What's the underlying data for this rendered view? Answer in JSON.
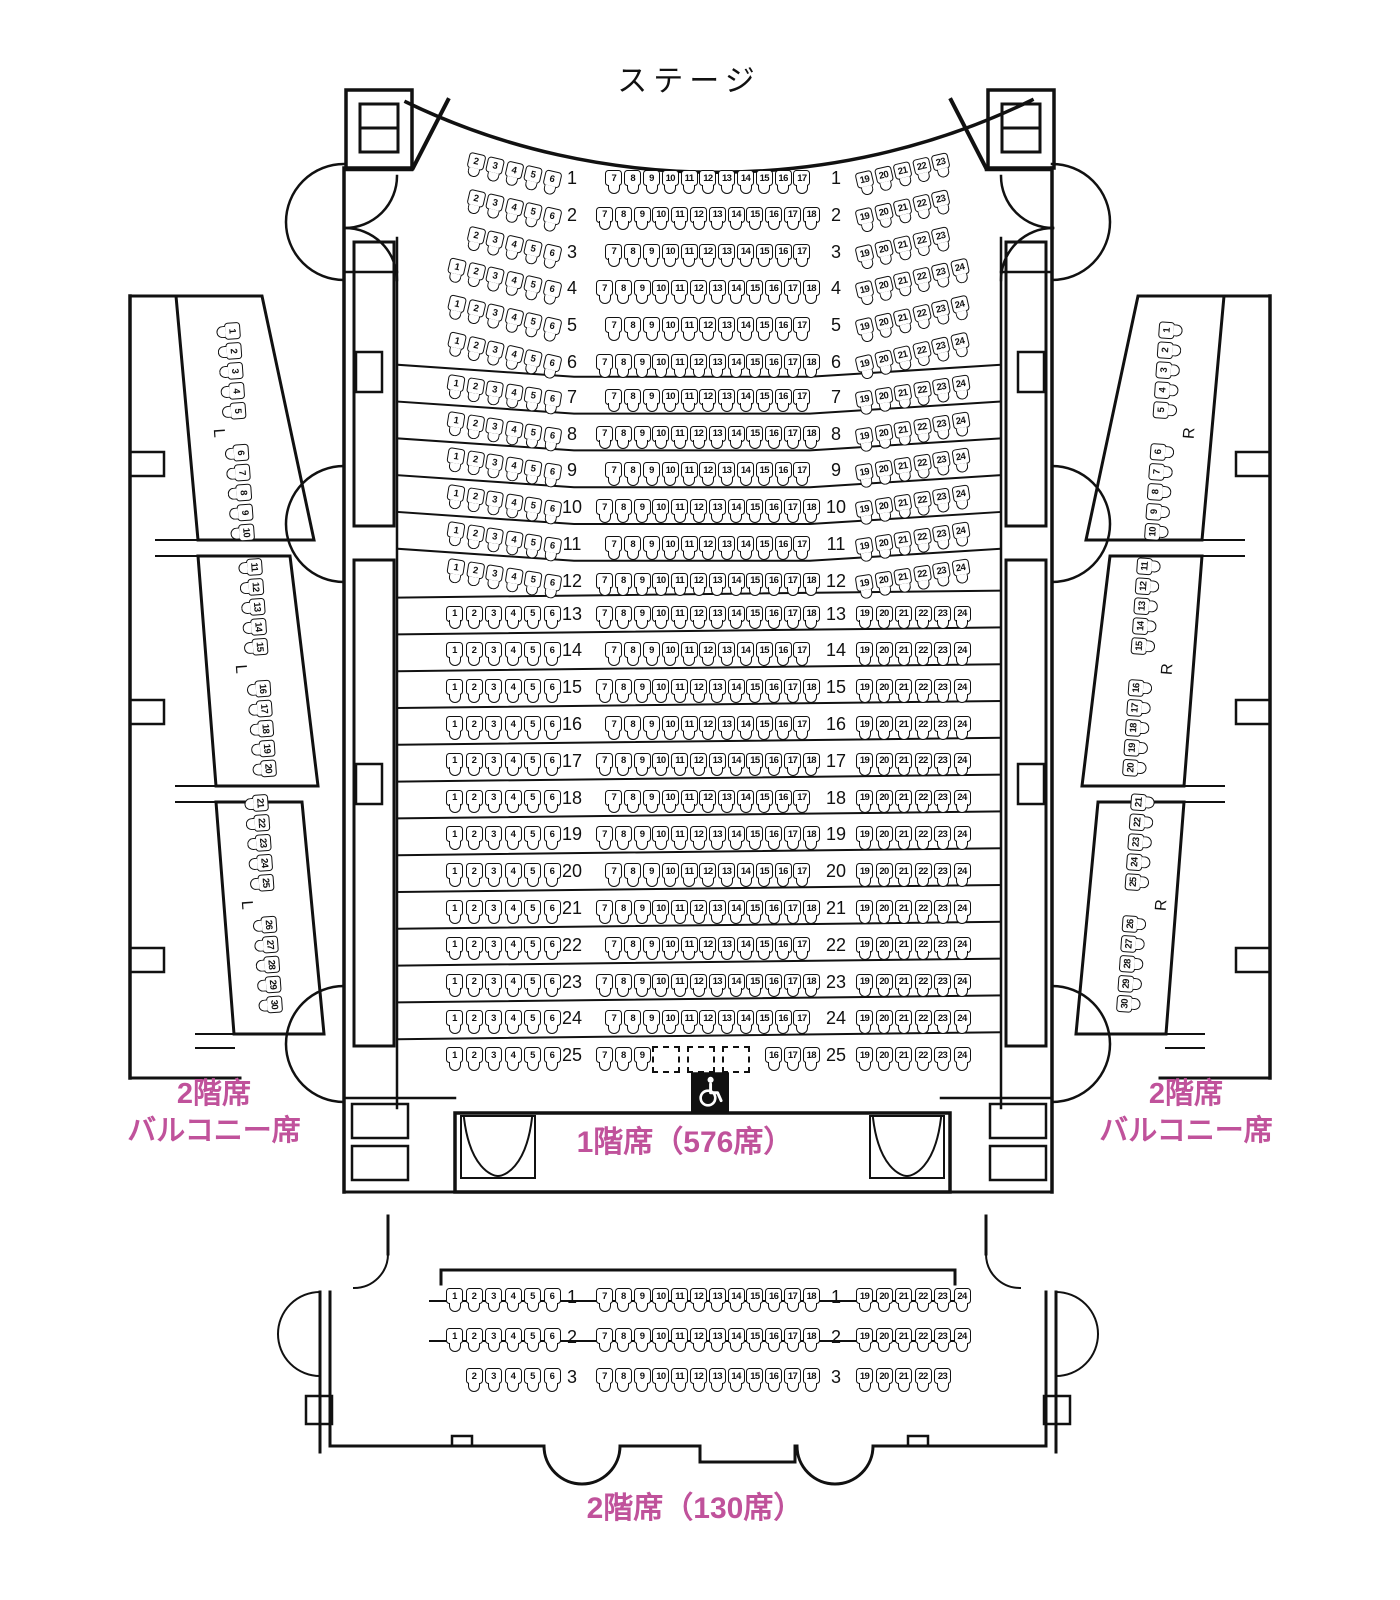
{
  "labels": {
    "stage": "ステージ",
    "floor1": "1階席（576席）",
    "floor2": "2階席（130席）",
    "balcony_line1": "2階席",
    "balcony_line2": "バルコニー席"
  },
  "colors": {
    "accent_pink": "#c0529b",
    "line": "#111111"
  },
  "icons": {
    "wheelchair_icon": "♿"
  },
  "floor1": {
    "label": "1階席（576席）",
    "rows": [
      {
        "n": 1,
        "left": [
          2,
          3,
          4,
          5,
          6
        ],
        "center": [
          7,
          8,
          9,
          10,
          11,
          12,
          13,
          14,
          15,
          16,
          17
        ],
        "right": [
          19,
          20,
          21,
          22,
          23
        ]
      },
      {
        "n": 2,
        "left": [
          2,
          3,
          4,
          5,
          6
        ],
        "center": [
          7,
          8,
          9,
          10,
          11,
          12,
          13,
          14,
          15,
          16,
          17,
          18
        ],
        "right": [
          19,
          20,
          21,
          22,
          23
        ]
      },
      {
        "n": 3,
        "left": [
          2,
          3,
          4,
          5,
          6
        ],
        "center": [
          7,
          8,
          9,
          10,
          11,
          12,
          13,
          14,
          15,
          16,
          17
        ],
        "right": [
          19,
          20,
          21,
          22,
          23
        ]
      },
      {
        "n": 4,
        "left": [
          1,
          2,
          3,
          4,
          5,
          6
        ],
        "center": [
          7,
          8,
          9,
          10,
          11,
          12,
          13,
          14,
          15,
          16,
          17,
          18
        ],
        "right": [
          19,
          20,
          21,
          22,
          23,
          24
        ]
      },
      {
        "n": 5,
        "left": [
          1,
          2,
          3,
          4,
          5,
          6
        ],
        "center": [
          7,
          8,
          9,
          10,
          11,
          12,
          13,
          14,
          15,
          16,
          17
        ],
        "right": [
          19,
          20,
          21,
          22,
          23,
          24
        ]
      },
      {
        "n": 6,
        "left": [
          1,
          2,
          3,
          4,
          5,
          6
        ],
        "center": [
          7,
          8,
          9,
          10,
          11,
          12,
          13,
          14,
          15,
          16,
          17,
          18
        ],
        "right": [
          19,
          20,
          21,
          22,
          23,
          24
        ]
      },
      {
        "n": 7,
        "left": [
          1,
          2,
          3,
          4,
          5,
          6
        ],
        "center": [
          7,
          8,
          9,
          10,
          11,
          12,
          13,
          14,
          15,
          16,
          17
        ],
        "right": [
          19,
          20,
          21,
          22,
          23,
          24
        ]
      },
      {
        "n": 8,
        "left": [
          1,
          2,
          3,
          4,
          5,
          6
        ],
        "center": [
          7,
          8,
          9,
          10,
          11,
          12,
          13,
          14,
          15,
          16,
          17,
          18
        ],
        "right": [
          19,
          20,
          21,
          22,
          23,
          24
        ]
      },
      {
        "n": 9,
        "left": [
          1,
          2,
          3,
          4,
          5,
          6
        ],
        "center": [
          7,
          8,
          9,
          10,
          11,
          12,
          13,
          14,
          15,
          16,
          17
        ],
        "right": [
          19,
          20,
          21,
          22,
          23,
          24
        ]
      },
      {
        "n": 10,
        "left": [
          1,
          2,
          3,
          4,
          5,
          6
        ],
        "center": [
          7,
          8,
          9,
          10,
          11,
          12,
          13,
          14,
          15,
          16,
          17,
          18
        ],
        "right": [
          19,
          20,
          21,
          22,
          23,
          24
        ]
      },
      {
        "n": 11,
        "left": [
          1,
          2,
          3,
          4,
          5,
          6
        ],
        "center": [
          7,
          8,
          9,
          10,
          11,
          12,
          13,
          14,
          15,
          16,
          17
        ],
        "right": [
          19,
          20,
          21,
          22,
          23,
          24
        ]
      },
      {
        "n": 12,
        "left": [
          1,
          2,
          3,
          4,
          5,
          6
        ],
        "center": [
          7,
          8,
          9,
          10,
          11,
          12,
          13,
          14,
          15,
          16,
          17,
          18
        ],
        "right": [
          19,
          20,
          21,
          22,
          23,
          24
        ]
      },
      {
        "n": 13,
        "left": [
          1,
          2,
          3,
          4,
          5,
          6
        ],
        "center": [
          7,
          8,
          9,
          10,
          11,
          12,
          13,
          14,
          15,
          16,
          17,
          18
        ],
        "right": [
          19,
          20,
          21,
          22,
          23,
          24
        ]
      },
      {
        "n": 14,
        "left": [
          1,
          2,
          3,
          4,
          5,
          6
        ],
        "center": [
          7,
          8,
          9,
          10,
          11,
          12,
          13,
          14,
          15,
          16,
          17
        ],
        "right": [
          19,
          20,
          21,
          22,
          23,
          24
        ]
      },
      {
        "n": 15,
        "left": [
          1,
          2,
          3,
          4,
          5,
          6
        ],
        "center": [
          7,
          8,
          9,
          10,
          11,
          12,
          13,
          14,
          15,
          16,
          17,
          18
        ],
        "right": [
          19,
          20,
          21,
          22,
          23,
          24
        ]
      },
      {
        "n": 16,
        "left": [
          1,
          2,
          3,
          4,
          5,
          6
        ],
        "center": [
          7,
          8,
          9,
          10,
          11,
          12,
          13,
          14,
          15,
          16,
          17
        ],
        "right": [
          19,
          20,
          21,
          22,
          23,
          24
        ]
      },
      {
        "n": 17,
        "left": [
          1,
          2,
          3,
          4,
          5,
          6
        ],
        "center": [
          7,
          8,
          9,
          10,
          11,
          12,
          13,
          14,
          15,
          16,
          17,
          18
        ],
        "right": [
          19,
          20,
          21,
          22,
          23,
          24
        ]
      },
      {
        "n": 18,
        "left": [
          1,
          2,
          3,
          4,
          5,
          6
        ],
        "center": [
          7,
          8,
          9,
          10,
          11,
          12,
          13,
          14,
          15,
          16,
          17
        ],
        "right": [
          19,
          20,
          21,
          22,
          23,
          24
        ]
      },
      {
        "n": 19,
        "left": [
          1,
          2,
          3,
          4,
          5,
          6
        ],
        "center": [
          7,
          8,
          9,
          10,
          11,
          12,
          13,
          14,
          15,
          16,
          17,
          18
        ],
        "right": [
          19,
          20,
          21,
          22,
          23,
          24
        ]
      },
      {
        "n": 20,
        "left": [
          1,
          2,
          3,
          4,
          5,
          6
        ],
        "center": [
          7,
          8,
          9,
          10,
          11,
          12,
          13,
          14,
          15,
          16,
          17
        ],
        "right": [
          19,
          20,
          21,
          22,
          23,
          24
        ]
      },
      {
        "n": 21,
        "left": [
          1,
          2,
          3,
          4,
          5,
          6
        ],
        "center": [
          7,
          8,
          9,
          10,
          11,
          12,
          13,
          14,
          15,
          16,
          17,
          18
        ],
        "right": [
          19,
          20,
          21,
          22,
          23,
          24
        ]
      },
      {
        "n": 22,
        "left": [
          1,
          2,
          3,
          4,
          5,
          6
        ],
        "center": [
          7,
          8,
          9,
          10,
          11,
          12,
          13,
          14,
          15,
          16,
          17
        ],
        "right": [
          19,
          20,
          21,
          22,
          23,
          24
        ]
      },
      {
        "n": 23,
        "left": [
          1,
          2,
          3,
          4,
          5,
          6
        ],
        "center": [
          7,
          8,
          9,
          10,
          11,
          12,
          13,
          14,
          15,
          16,
          17,
          18
        ],
        "right": [
          19,
          20,
          21,
          22,
          23,
          24
        ]
      },
      {
        "n": 24,
        "left": [
          1,
          2,
          3,
          4,
          5,
          6
        ],
        "center": [
          7,
          8,
          9,
          10,
          11,
          12,
          13,
          14,
          15,
          16,
          17
        ],
        "right": [
          19,
          20,
          21,
          22,
          23,
          24
        ]
      },
      {
        "n": 25,
        "left": [
          1,
          2,
          3,
          4,
          5,
          6
        ],
        "center": [
          7,
          8,
          9,
          null,
          null,
          null,
          16,
          17,
          18
        ],
        "right": [
          19,
          20,
          21,
          22,
          23,
          24
        ]
      }
    ],
    "wheelchair_spaces": 3
  },
  "balconies": {
    "left": {
      "letter": "L",
      "groups": [
        {
          "front": [
            1,
            2,
            3,
            4,
            5
          ],
          "back": [
            6,
            7,
            8,
            9,
            10
          ]
        },
        {
          "front": [
            11,
            12,
            13,
            14,
            15
          ],
          "back": [
            16,
            17,
            18,
            19,
            20
          ]
        },
        {
          "front": [
            21,
            22,
            23,
            24,
            25
          ],
          "back": [
            26,
            27,
            28,
            29,
            30
          ]
        }
      ]
    },
    "right": {
      "letter": "R",
      "groups": [
        {
          "front": [
            1,
            2,
            3,
            4,
            5
          ],
          "back": [
            6,
            7,
            8,
            9,
            10
          ]
        },
        {
          "front": [
            11,
            12,
            13,
            14,
            15
          ],
          "back": [
            16,
            17,
            18,
            19,
            20
          ]
        },
        {
          "front": [
            21,
            22,
            23,
            24,
            25
          ],
          "back": [
            26,
            27,
            28,
            29,
            30
          ]
        }
      ]
    }
  },
  "floor2": {
    "label": "2階席（130席）",
    "rows": [
      {
        "n": 1,
        "left": [
          1,
          2,
          3,
          4,
          5,
          6
        ],
        "center": [
          7,
          8,
          9,
          10,
          11,
          12,
          13,
          14,
          15,
          16,
          17,
          18
        ],
        "right": [
          19,
          20,
          21,
          22,
          23,
          24
        ]
      },
      {
        "n": 2,
        "left": [
          1,
          2,
          3,
          4,
          5,
          6
        ],
        "center": [
          7,
          8,
          9,
          10,
          11,
          12,
          13,
          14,
          15,
          16,
          17,
          18
        ],
        "right": [
          19,
          20,
          21,
          22,
          23,
          24
        ]
      },
      {
        "n": 3,
        "left": [
          2,
          3,
          4,
          5,
          6
        ],
        "center": [
          7,
          8,
          9,
          10,
          11,
          12,
          13,
          14,
          15,
          16,
          17,
          18
        ],
        "right": [
          19,
          20,
          21,
          22,
          23
        ]
      }
    ]
  }
}
